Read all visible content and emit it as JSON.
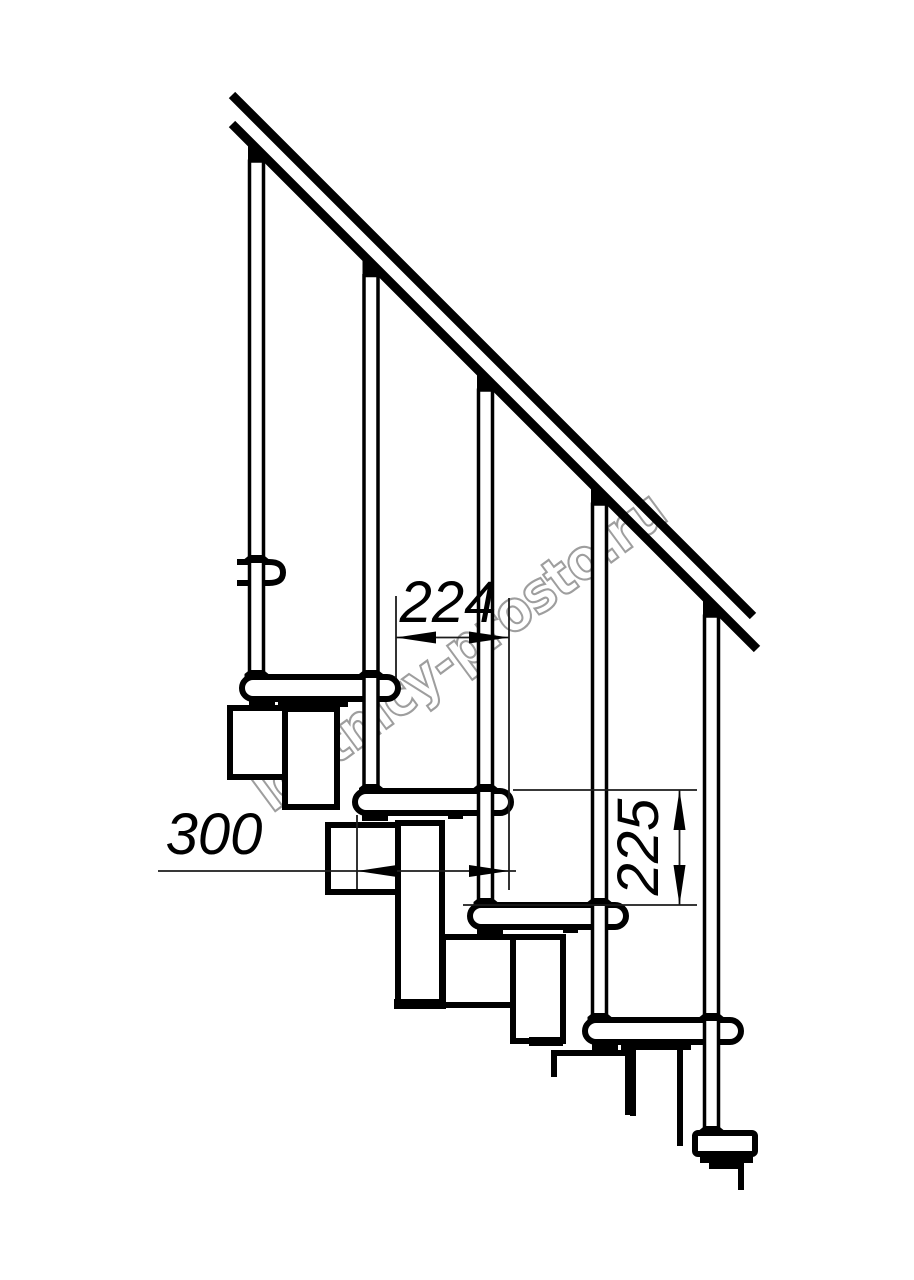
{
  "drawing": {
    "title": "modular staircase side elevation technical drawing",
    "watermark": {
      "text": "lestnicy-prosto.ru",
      "color": "#9e9e9e"
    },
    "dimensions": {
      "step_run": {
        "value": "224"
      },
      "tread_depth": {
        "value": "300"
      },
      "riser_height": {
        "value": "225"
      }
    },
    "colors": {
      "line": "#000000",
      "background": "#ffffff",
      "dimension_text": "#000000",
      "watermark_outline": "#9e9e9e"
    }
  }
}
